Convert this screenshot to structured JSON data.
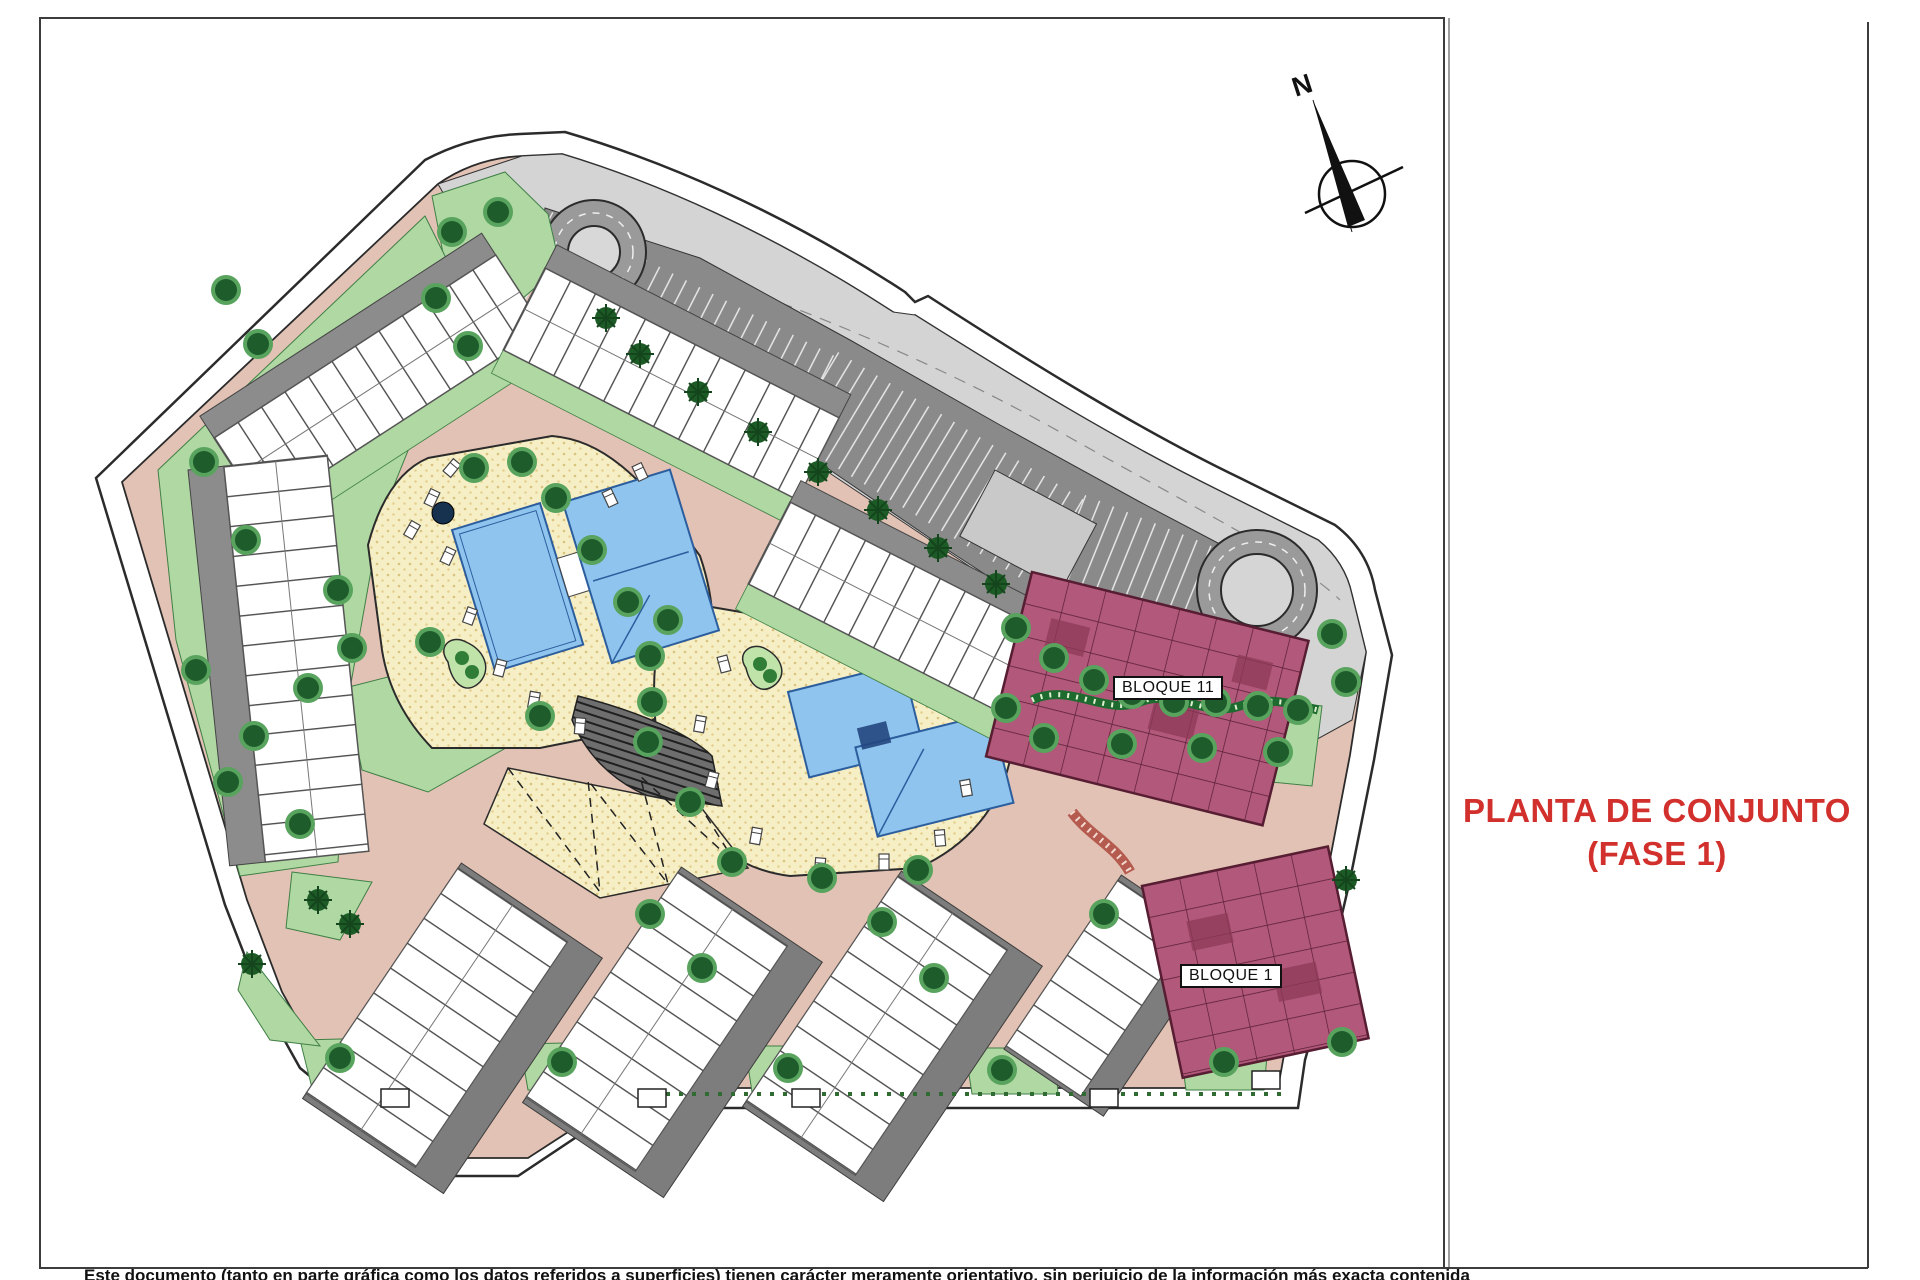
{
  "title": {
    "line1": "PLANTA DE CONJUNTO",
    "line2": "(FASE 1)"
  },
  "labels": {
    "bloque11": "BLOQUE 11",
    "bloque1": "BLOQUE 1"
  },
  "compass": {
    "label": "N"
  },
  "disclaimer": {
    "text": "Este documento (tanto en parte gráfica como los datos referidos a superficies) tienen carácter meramente orientativo, sin perjuicio de la información más exacta contenida"
  },
  "colors": {
    "title-red": "#D2302C",
    "road-salmon": "#E2C2B4",
    "gray-light": "#D4D4D4",
    "gray-dark": "#8A8A8A",
    "roof-gray": "#7D7D7D",
    "lawn-green": "#AFD8A2",
    "strip-green": "#3F7F46",
    "tree-dark": "#1F5C2B",
    "tree-light": "#58A35D",
    "deck-cream": "#F6EFC6",
    "pool-blue": "#8FC4EE",
    "pool-line": "#2C5E9E",
    "bloque-maroon": "#B2587A",
    "bloque-line": "#571D32",
    "building-white": "#FFFFFF",
    "building-line": "#555555",
    "frame-gray": "#3C3C3C"
  }
}
